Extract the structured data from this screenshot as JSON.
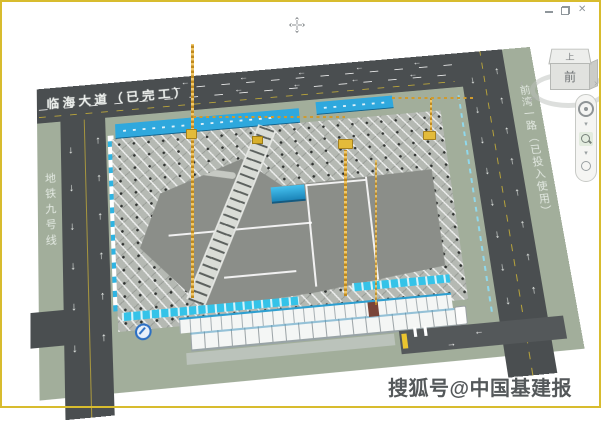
{
  "viewport": {
    "type": "3d-bim-site-plan"
  },
  "window_controls": {
    "close_glyph": "✕"
  },
  "viewcube": {
    "top": "上",
    "front": "前"
  },
  "navbar": {
    "tools": [
      "full-navigation-wheel",
      "zoom-window"
    ]
  },
  "plan": {
    "top_road_label": "临海大道（已完工）",
    "left_road_label": "地铁九号线",
    "right_road_label": "前湾一路（已投入使用）",
    "markings": {
      "left": "←",
      "right": "→",
      "up": "↑",
      "down": "↓"
    }
  },
  "watermark": "搜狐号@中国基建报",
  "colors": {
    "frame_yellow": "#d8bc2e",
    "road_gray": "#4a4e50",
    "verge_green": "#a2ae9b",
    "banner_blue": "#2fa8dd",
    "banner_cyan": "#35c3e8",
    "crane_orange": "#d79b2a",
    "pit_floor": "#8b8e89",
    "lane_yellow": "#b7a33b"
  }
}
